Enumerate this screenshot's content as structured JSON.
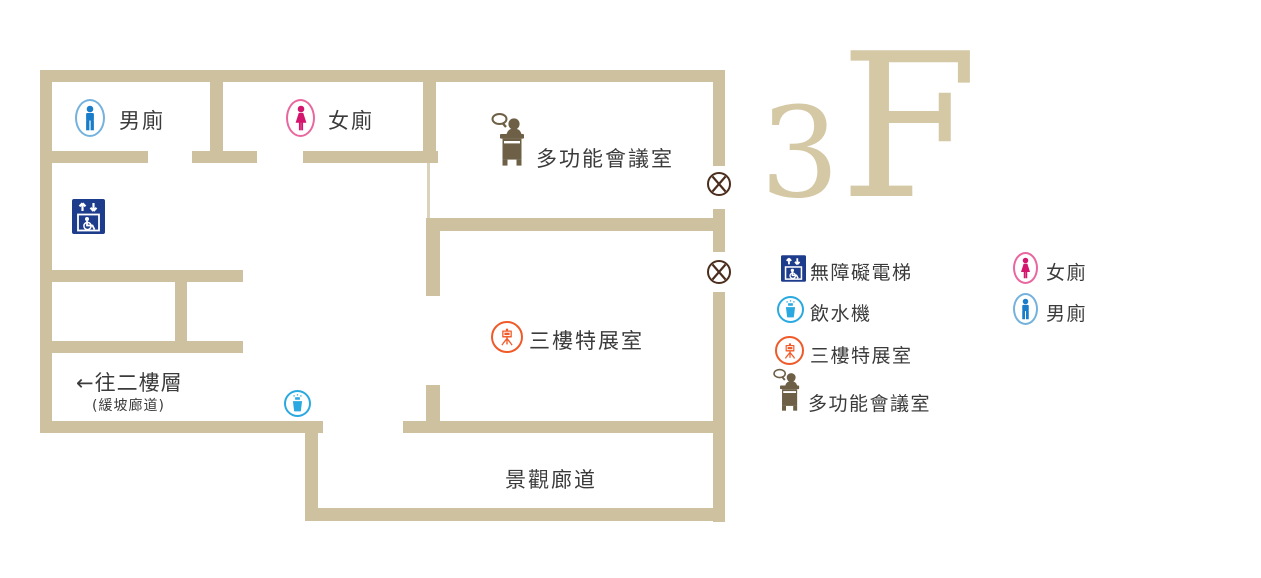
{
  "floor_title": {
    "number": "3",
    "letter": "F"
  },
  "plan": {
    "mens_toilet_label": "男廁",
    "womens_toilet_label": "女廁",
    "meeting_room_label": "多功能會議室",
    "exhibition_room_label": "三樓特展室",
    "scenic_corridor_label": "景觀廊道",
    "to_second_floor_label": "←往二樓層",
    "ramp_corridor_note": "(緩坡廊道)"
  },
  "legend": {
    "left": [
      {
        "name": "accessible-elevator",
        "label": "無障礙電梯"
      },
      {
        "name": "water-fountain",
        "label": "飲水機"
      },
      {
        "name": "exhibition-room",
        "label": "三樓特展室"
      },
      {
        "name": "meeting-room",
        "label": "多功能會議室"
      }
    ],
    "right": [
      {
        "name": "womens-toilet",
        "label": "女廁"
      },
      {
        "name": "mens-toilet",
        "label": "男廁"
      }
    ]
  },
  "colors": {
    "wall": "#cdc1a0",
    "floor_title": "#d4c8a5",
    "mens_blue": "#1a7dc9",
    "womens_pink": "#d4156d",
    "elevator_navy": "#1e3c8c",
    "water_blue": "#29a9e0",
    "exhibition_orange": "#f05a28",
    "meeting_brown": "#6e6046",
    "no_entry_brown": "#4b2d1d",
    "text": "#3b3b3b"
  }
}
